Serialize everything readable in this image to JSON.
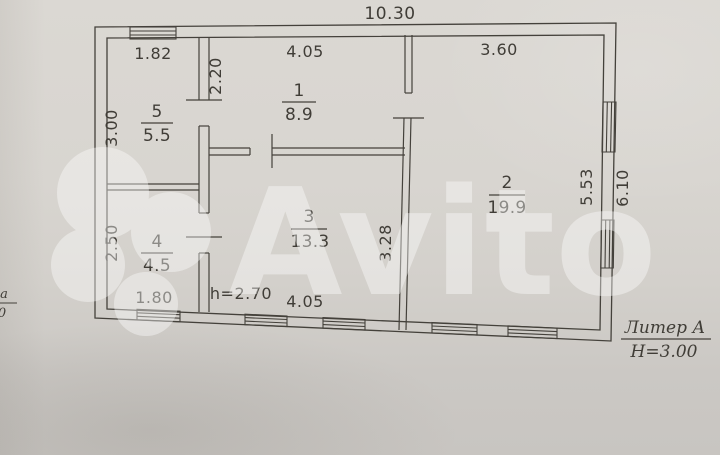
{
  "watermark": {
    "text": "Avito"
  },
  "dims": {
    "total_width": "10.30",
    "total_height": "6.10",
    "room1_width": "4.05",
    "room1_height": "2.20",
    "room2_width": "3.60",
    "room2_height": "5.53",
    "room3_width": "4.05",
    "room3_height": "3.28",
    "room4_width": "1.80",
    "room4_height": "2.50",
    "room5_width": "1.82",
    "room5_height": "3.00",
    "ceiling_height": "h=2.70"
  },
  "rooms": {
    "r1": {
      "num": "1",
      "area": "8.9"
    },
    "r2": {
      "num": "2",
      "area": "19.9"
    },
    "r3": {
      "num": "3",
      "area": "13.3"
    },
    "r4": {
      "num": "4",
      "area": "4.5"
    },
    "r5": {
      "num": "5",
      "area": "5.5"
    }
  },
  "annotation": {
    "liter": "Литер А",
    "building_height": "Н=3.00"
  },
  "edge_fragment": {
    "top": "а",
    "bottom": "0"
  }
}
